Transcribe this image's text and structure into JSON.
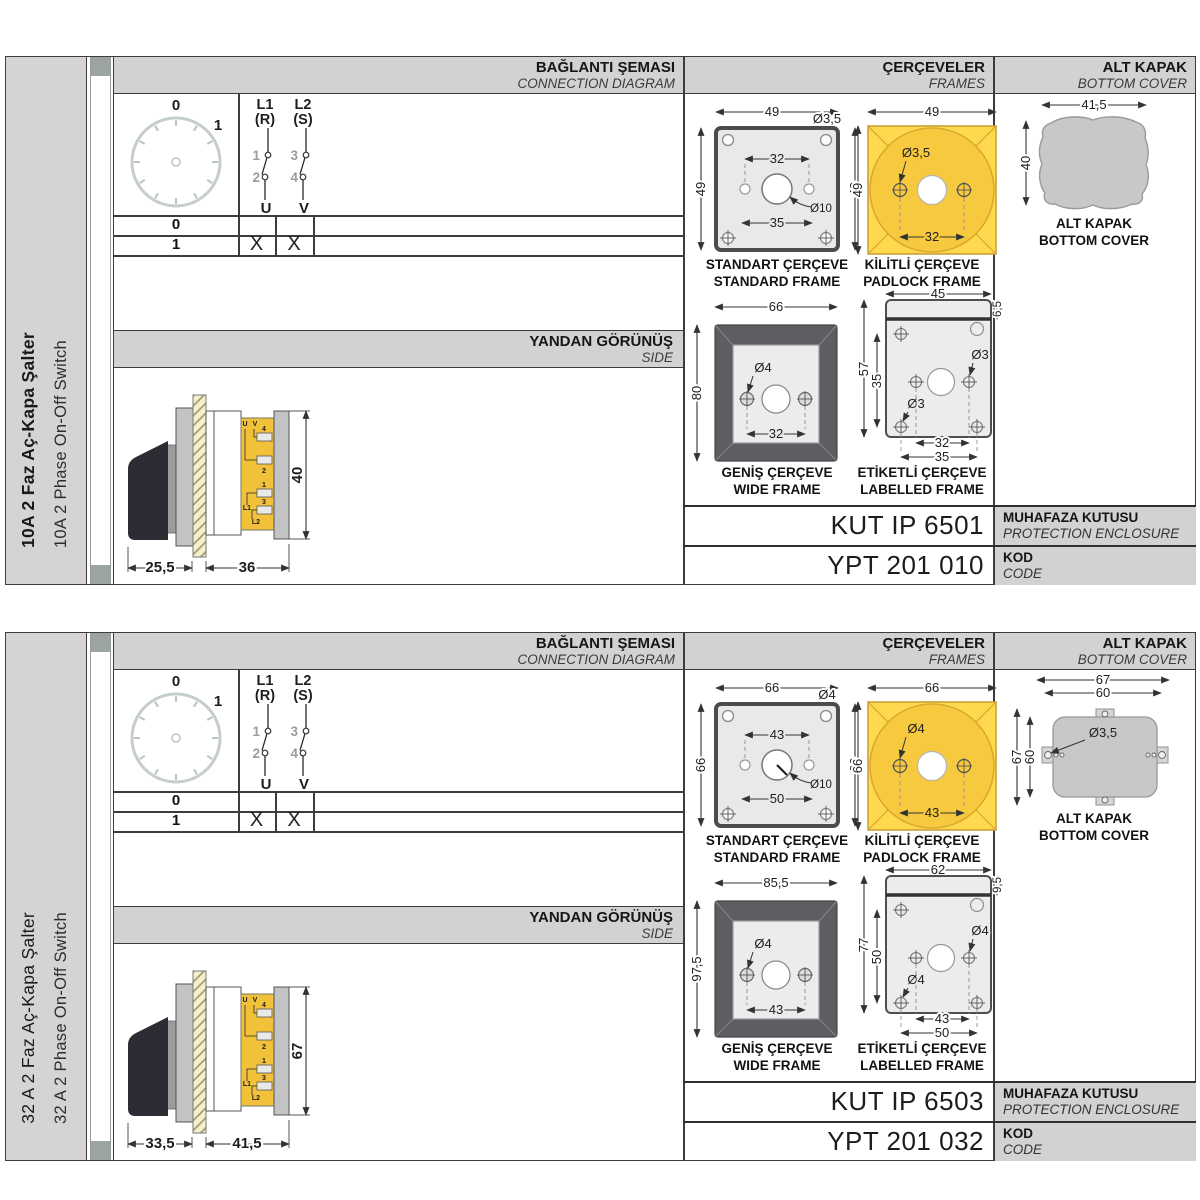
{
  "colors": {
    "accent_yellow": "#ffd94d",
    "padlock_circle": "#f7c93f",
    "frame_dark": "#5e5e62",
    "panel_gray": "#d2d2d2",
    "terminal_yellow": "#f1c139"
  },
  "panels": [
    {
      "sidebar": {
        "title_tr": "10A 2 Faz Aç-Kapa Şalter",
        "title_en": "10A 2 Phase On-Off Switch"
      },
      "headers": {
        "conn_tr": "BAĞLANTI ŞEMASI",
        "conn_en": "CONNECTION DIAGRAM",
        "frames_tr": "ÇERÇEVELER",
        "frames_en": "FRAMES",
        "cover_tr": "ALT KAPAK",
        "cover_en": "BOTTOM COVER"
      },
      "conn": {
        "dial_0": "0",
        "dial_1": "1",
        "l1": "L1",
        "l1_phase": "(R)",
        "l2": "L2",
        "l2_phase": "(S)",
        "c1": "1",
        "c2": "2",
        "c3": "3",
        "c4": "4",
        "out1": "U",
        "out2": "V",
        "row0": "0",
        "row1": "1",
        "mark1": "X",
        "mark2": "X"
      },
      "side": {
        "title_tr": "YANDAN GÖRÜNÜŞ",
        "title_en": "SIDE",
        "dim_front": "25,5",
        "dim_body": "36",
        "dim_height": "40",
        "lbl_u": "U",
        "lbl_v": "V",
        "lbl_4": "4",
        "lbl_2": "2",
        "lbl_1": "1",
        "lbl_3": "3",
        "lbl_l1": "L1",
        "lbl_l2": "L2"
      },
      "frames": {
        "standard": {
          "caption_tr": "STANDART ÇERÇEVE",
          "caption_en": "STANDARD FRAME",
          "dim_width": "49",
          "dim_height_left": "49",
          "dim_height_right": "49",
          "dim_hole": "Ø3,5",
          "dim_span": "32",
          "dim_center_hole": "Ø10",
          "dim_span_outer": "35"
        },
        "padlock": {
          "caption_tr": "KİLİTLİ ÇERÇEVE",
          "caption_en": "PADLOCK FRAME",
          "dim_width": "49",
          "dim_height": "49",
          "dim_hole": "Ø3,5",
          "dim_span": "32"
        },
        "wide": {
          "caption_tr": "GENİŞ ÇERÇEVE",
          "caption_en": "WIDE FRAME",
          "dim_width": "66",
          "dim_height": "80",
          "dim_hole": "Ø4",
          "dim_span": "32"
        },
        "labelled": {
          "caption_tr": "ETİKETLİ ÇERÇEVE",
          "caption_en": "LABELLED FRAME",
          "dim_width": "45",
          "dim_strip": "6,5",
          "dim_height": "57",
          "dim_inner_height": "35",
          "dim_hole_right": "Ø3",
          "dim_hole_left": "Ø3",
          "dim_span": "32",
          "dim_span_outer": "35"
        }
      },
      "cover": {
        "caption_tr": "ALT KAPAK",
        "caption_en": "BOTTOM COVER",
        "dim_width": "41,5",
        "dim_height": "40"
      },
      "codes": {
        "enclosure_value": "KUT IP 6501",
        "enclosure_tr": "MUHAFAZA KUTUSU",
        "enclosure_en": "PROTECTION ENCLOSURE",
        "code_value": "YPT 201 010",
        "code_tr": "KOD",
        "code_en": "CODE"
      }
    },
    {
      "sidebar": {
        "title_tr": "32 A 2 Faz Aç-Kapa Şalter",
        "title_en": "32 A 2 Phase On-Off Switch"
      },
      "headers": {
        "conn_tr": "BAĞLANTI ŞEMASI",
        "conn_en": "CONNECTION DIAGRAM",
        "frames_tr": "ÇERÇEVELER",
        "frames_en": "FRAMES",
        "cover_tr": "ALT KAPAK",
        "cover_en": "BOTTOM COVER"
      },
      "conn": {
        "dial_0": "0",
        "dial_1": "1",
        "l1": "L1",
        "l1_phase": "(R)",
        "l2": "L2",
        "l2_phase": "(S)",
        "c1": "1",
        "c2": "2",
        "c3": "3",
        "c4": "4",
        "out1": "U",
        "out2": "V",
        "row0": "0",
        "row1": "1",
        "mark1": "X",
        "mark2": "X"
      },
      "side": {
        "title_tr": "YANDAN GÖRÜNÜŞ",
        "title_en": "SIDE",
        "dim_front": "33,5",
        "dim_body": "41,5",
        "dim_height": "67",
        "lbl_u": "U",
        "lbl_v": "V",
        "lbl_4": "4",
        "lbl_2": "2",
        "lbl_1": "1",
        "lbl_3": "3",
        "lbl_l1": "L1",
        "lbl_l2": "L2"
      },
      "frames": {
        "standard": {
          "caption_tr": "STANDART ÇERÇEVE",
          "caption_en": "STANDARD FRAME",
          "dim_width": "66",
          "dim_height_left": "66",
          "dim_height_right": "66",
          "dim_hole": "Ø4",
          "dim_span": "43",
          "dim_center_hole": "Ø10",
          "dim_span_outer": "50"
        },
        "padlock": {
          "caption_tr": "KİLİTLİ ÇERÇEVE",
          "caption_en": "PADLOCK FRAME",
          "dim_width": "66",
          "dim_height": "66",
          "dim_hole": "Ø4",
          "dim_span": "43"
        },
        "wide": {
          "caption_tr": "GENİŞ ÇERÇEVE",
          "caption_en": "WIDE FRAME",
          "dim_width": "85,5",
          "dim_height": "97,5",
          "dim_hole": "Ø4",
          "dim_span": "43"
        },
        "labelled": {
          "caption_tr": "ETİKETLİ ÇERÇEVE",
          "caption_en": "LABELLED FRAME",
          "dim_width": "62",
          "dim_strip": "9,5",
          "dim_height": "77",
          "dim_inner_height": "50",
          "dim_hole_right": "Ø4",
          "dim_hole_left": "Ø4",
          "dim_span": "43",
          "dim_span_outer": "50"
        }
      },
      "cover": {
        "caption_tr": "ALT KAPAK",
        "caption_en": "BOTTOM COVER",
        "dim_width_outer": "67",
        "dim_width_inner": "60",
        "dim_height_outer": "67",
        "dim_height_inner": "60",
        "dim_hole": "Ø3,5"
      },
      "codes": {
        "enclosure_value": "KUT IP 6503",
        "enclosure_tr": "MUHAFAZA KUTUSU",
        "enclosure_en": "PROTECTION ENCLOSURE",
        "code_value": "YPT 201 032",
        "code_tr": "KOD",
        "code_en": "CODE"
      }
    }
  ]
}
